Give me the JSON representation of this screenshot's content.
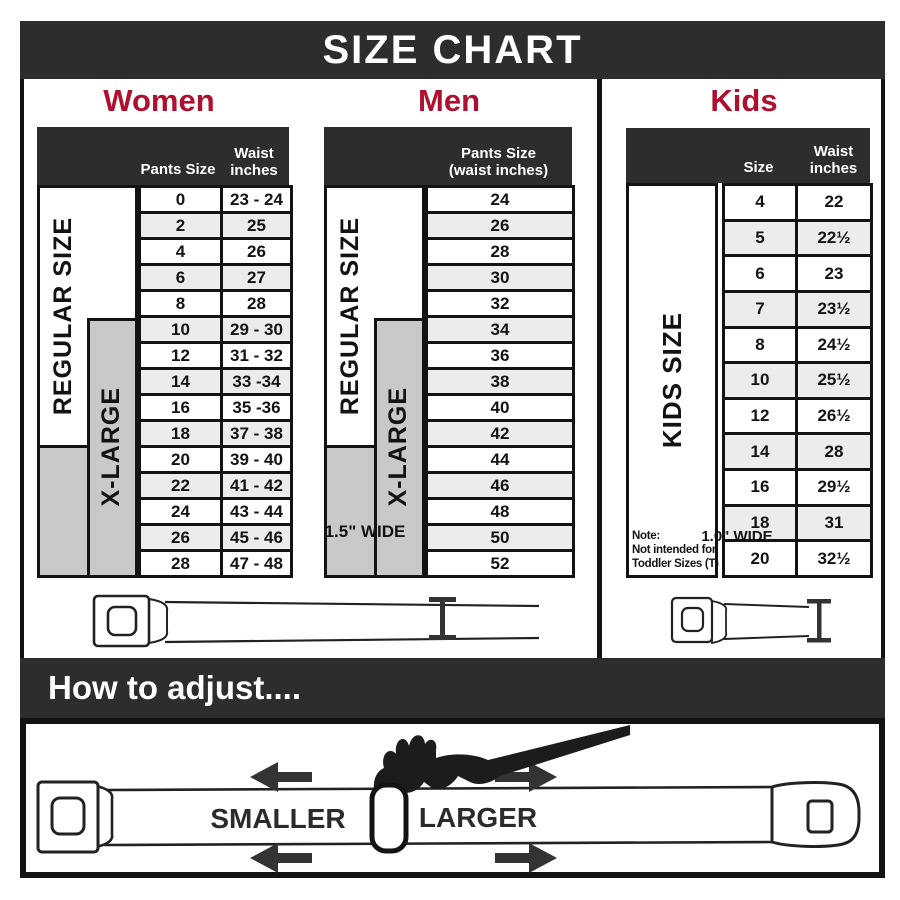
{
  "title": "SIZE CHART",
  "colors": {
    "accent": "#b0102f",
    "dark": "#2d2d2d",
    "gray": "#c9c9c9",
    "row_alt": "#ececec",
    "line": "#131313"
  },
  "side_labels": {
    "regular": "REGULAR SIZE",
    "xlarge": "X-LARGE",
    "kids": "KIDS SIZE"
  },
  "women": {
    "header": "Women",
    "col1": "Pants Size",
    "col2": "Waist inches",
    "rows": [
      {
        "size": "0",
        "waist": "23 - 24"
      },
      {
        "size": "2",
        "waist": "25"
      },
      {
        "size": "4",
        "waist": "26"
      },
      {
        "size": "6",
        "waist": "27"
      },
      {
        "size": "8",
        "waist": "28"
      },
      {
        "size": "10",
        "waist": "29 - 30"
      },
      {
        "size": "12",
        "waist": "31 - 32"
      },
      {
        "size": "14",
        "waist": "33 -34"
      },
      {
        "size": "16",
        "waist": "35 -36"
      },
      {
        "size": "18",
        "waist": "37 - 38"
      },
      {
        "size": "20",
        "waist": "39 - 40"
      },
      {
        "size": "22",
        "waist": "41 - 42"
      },
      {
        "size": "24",
        "waist": "43 - 44"
      },
      {
        "size": "26",
        "waist": "45 - 46"
      },
      {
        "size": "28",
        "waist": "47 - 48"
      }
    ]
  },
  "men": {
    "header": "Men",
    "col1_line1": "Pants Size",
    "col1_line2": "(waist inches)",
    "rows": [
      "24",
      "26",
      "28",
      "30",
      "32",
      "34",
      "36",
      "38",
      "40",
      "42",
      "44",
      "46",
      "48",
      "50",
      "52"
    ]
  },
  "kids": {
    "header": "Kids",
    "col1": "Size",
    "col2": "Waist inches",
    "rows": [
      {
        "size": "4",
        "waist": "22"
      },
      {
        "size": "5",
        "waist": "22½"
      },
      {
        "size": "6",
        "waist": "23"
      },
      {
        "size": "7",
        "waist": "23½"
      },
      {
        "size": "8",
        "waist": "24½"
      },
      {
        "size": "10",
        "waist": "25½"
      },
      {
        "size": "12",
        "waist": "26½"
      },
      {
        "size": "14",
        "waist": "28"
      },
      {
        "size": "16",
        "waist": "29½"
      },
      {
        "size": "18",
        "waist": "31"
      },
      {
        "size": "20",
        "waist": "32½"
      }
    ],
    "note": [
      "Note:",
      "Not intended for",
      "Toddler Sizes (T)"
    ]
  },
  "belts": {
    "adult_width_label": "1.5\" WIDE",
    "kids_width_label": "1.0\" WIDE"
  },
  "adjust": {
    "header": "How to adjust....",
    "smaller_label": "SMALLER",
    "larger_label": "LARGER"
  }
}
